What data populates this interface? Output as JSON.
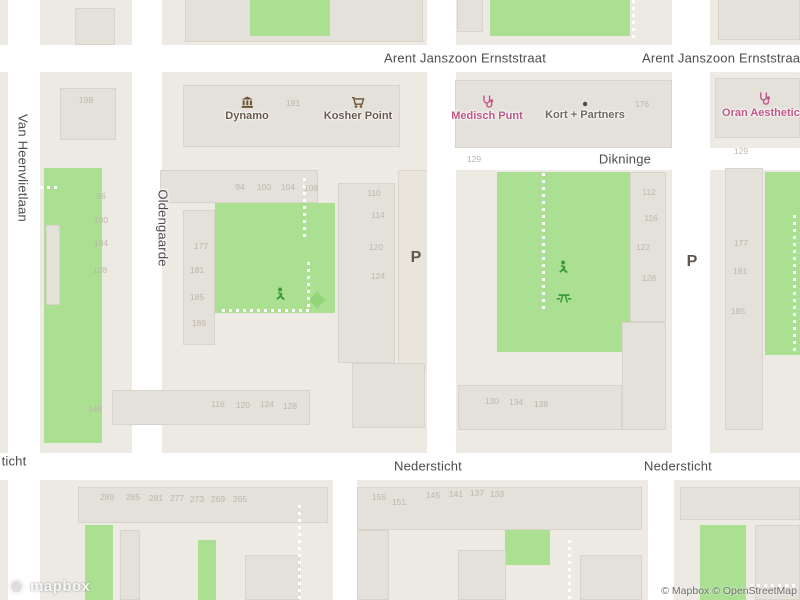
{
  "map": {
    "logo_text": "mapbox",
    "attribution": "© Mapbox © OpenStreetMap",
    "colors": {
      "land": "#edeae3",
      "road": "#ffffff",
      "building": "#e4e1da",
      "green": "#abe092",
      "poi_shop": "#6a5b4d",
      "poi_generic": "#6f6a62",
      "poi_medical": "#c05687",
      "park_icon_green": "#3e9b37",
      "parking_icon": "#60564a",
      "street_text": "#4d4d4d",
      "house_number": "#bdb7ab"
    },
    "streets": [
      {
        "name": "Arent Janszoon Ernststraat",
        "x": 465,
        "y": 58,
        "rotate": 0
      },
      {
        "name": "Arent Janszoon Ernststraat",
        "x": 723,
        "y": 58,
        "rotate": 0
      },
      {
        "name": "Dikninge",
        "x": 625,
        "y": 159,
        "rotate": 0
      },
      {
        "name": "Nedersticht",
        "x": 428,
        "y": 466,
        "rotate": 0
      },
      {
        "name": "Nedersticht",
        "x": 678,
        "y": 466,
        "rotate": 0
      },
      {
        "name": "ticht",
        "x": 14,
        "y": 461,
        "rotate": 0
      },
      {
        "name": "Van Heenvlietlaan",
        "x": 23,
        "y": 168,
        "rotate": 90
      },
      {
        "name": "Oldengaarde",
        "x": 163,
        "y": 228,
        "rotate": 90
      }
    ],
    "pois": [
      {
        "name": "Dynamo",
        "icon": "museum",
        "x": 247,
        "y": 96,
        "color": "#6a5b4d"
      },
      {
        "name": "Kosher Point",
        "icon": "cart",
        "x": 358,
        "y": 96,
        "color": "#6a5b4d"
      },
      {
        "name": "Medisch Punt",
        "icon": "stethoscope",
        "x": 487,
        "y": 95,
        "color": "#c05687"
      },
      {
        "name": "Kort + Partners",
        "icon": "dot",
        "x": 585,
        "y": 100,
        "color": "#6f6a62"
      },
      {
        "name": "Oran Aesthetics",
        "icon": "stethoscope",
        "x": 764,
        "y": 92,
        "color": "#c05687"
      }
    ],
    "amenities": [
      {
        "icon": "parking",
        "glyph": "P",
        "x": 416,
        "y": 258
      },
      {
        "icon": "parking",
        "glyph": "P",
        "x": 692,
        "y": 262
      },
      {
        "icon": "playground",
        "x": 281,
        "y": 294
      },
      {
        "icon": "playground",
        "x": 564,
        "y": 267
      },
      {
        "icon": "picnic",
        "x": 564,
        "y": 297
      }
    ],
    "house_numbers": [
      {
        "t": "199",
        "x": 86,
        "y": 100
      },
      {
        "t": "191",
        "x": 293,
        "y": 103
      },
      {
        "t": "176",
        "x": 642,
        "y": 104
      },
      {
        "t": "94",
        "x": 240,
        "y": 187
      },
      {
        "t": "100",
        "x": 264,
        "y": 187
      },
      {
        "t": "104",
        "x": 288,
        "y": 187
      },
      {
        "t": "108",
        "x": 311,
        "y": 188
      },
      {
        "t": "96",
        "x": 101,
        "y": 196
      },
      {
        "t": "100",
        "x": 101,
        "y": 220
      },
      {
        "t": "104",
        "x": 101,
        "y": 243
      },
      {
        "t": "108",
        "x": 100,
        "y": 270
      },
      {
        "t": "110",
        "x": 374,
        "y": 193
      },
      {
        "t": "114",
        "x": 378,
        "y": 215
      },
      {
        "t": "120",
        "x": 376,
        "y": 247
      },
      {
        "t": "124",
        "x": 378,
        "y": 276
      },
      {
        "t": "177",
        "x": 201,
        "y": 246
      },
      {
        "t": "181",
        "x": 197,
        "y": 270
      },
      {
        "t": "185",
        "x": 197,
        "y": 297
      },
      {
        "t": "189",
        "x": 199,
        "y": 323
      },
      {
        "t": "129",
        "x": 474,
        "y": 159
      },
      {
        "t": "129",
        "x": 741,
        "y": 151
      },
      {
        "t": "112",
        "x": 649,
        "y": 192
      },
      {
        "t": "116",
        "x": 651,
        "y": 218
      },
      {
        "t": "122",
        "x": 643,
        "y": 247
      },
      {
        "t": "128",
        "x": 649,
        "y": 278
      },
      {
        "t": "177",
        "x": 741,
        "y": 243
      },
      {
        "t": "181",
        "x": 740,
        "y": 271
      },
      {
        "t": "185",
        "x": 738,
        "y": 311
      },
      {
        "t": "148",
        "x": 95,
        "y": 409
      },
      {
        "t": "116",
        "x": 218,
        "y": 404
      },
      {
        "t": "120",
        "x": 243,
        "y": 405
      },
      {
        "t": "124",
        "x": 267,
        "y": 404
      },
      {
        "t": "128",
        "x": 290,
        "y": 406
      },
      {
        "t": "130",
        "x": 492,
        "y": 401
      },
      {
        "t": "134",
        "x": 516,
        "y": 402
      },
      {
        "t": "138",
        "x": 541,
        "y": 404
      },
      {
        "t": "289",
        "x": 107,
        "y": 497
      },
      {
        "t": "285",
        "x": 133,
        "y": 497
      },
      {
        "t": "281",
        "x": 156,
        "y": 498
      },
      {
        "t": "277",
        "x": 177,
        "y": 498
      },
      {
        "t": "273",
        "x": 197,
        "y": 499
      },
      {
        "t": "269",
        "x": 218,
        "y": 499
      },
      {
        "t": "265",
        "x": 240,
        "y": 499
      },
      {
        "t": "155",
        "x": 379,
        "y": 497
      },
      {
        "t": "151",
        "x": 399,
        "y": 502
      },
      {
        "t": "145",
        "x": 433,
        "y": 495
      },
      {
        "t": "141",
        "x": 456,
        "y": 494
      },
      {
        "t": "137",
        "x": 477,
        "y": 493
      },
      {
        "t": "133",
        "x": 497,
        "y": 494
      }
    ]
  }
}
